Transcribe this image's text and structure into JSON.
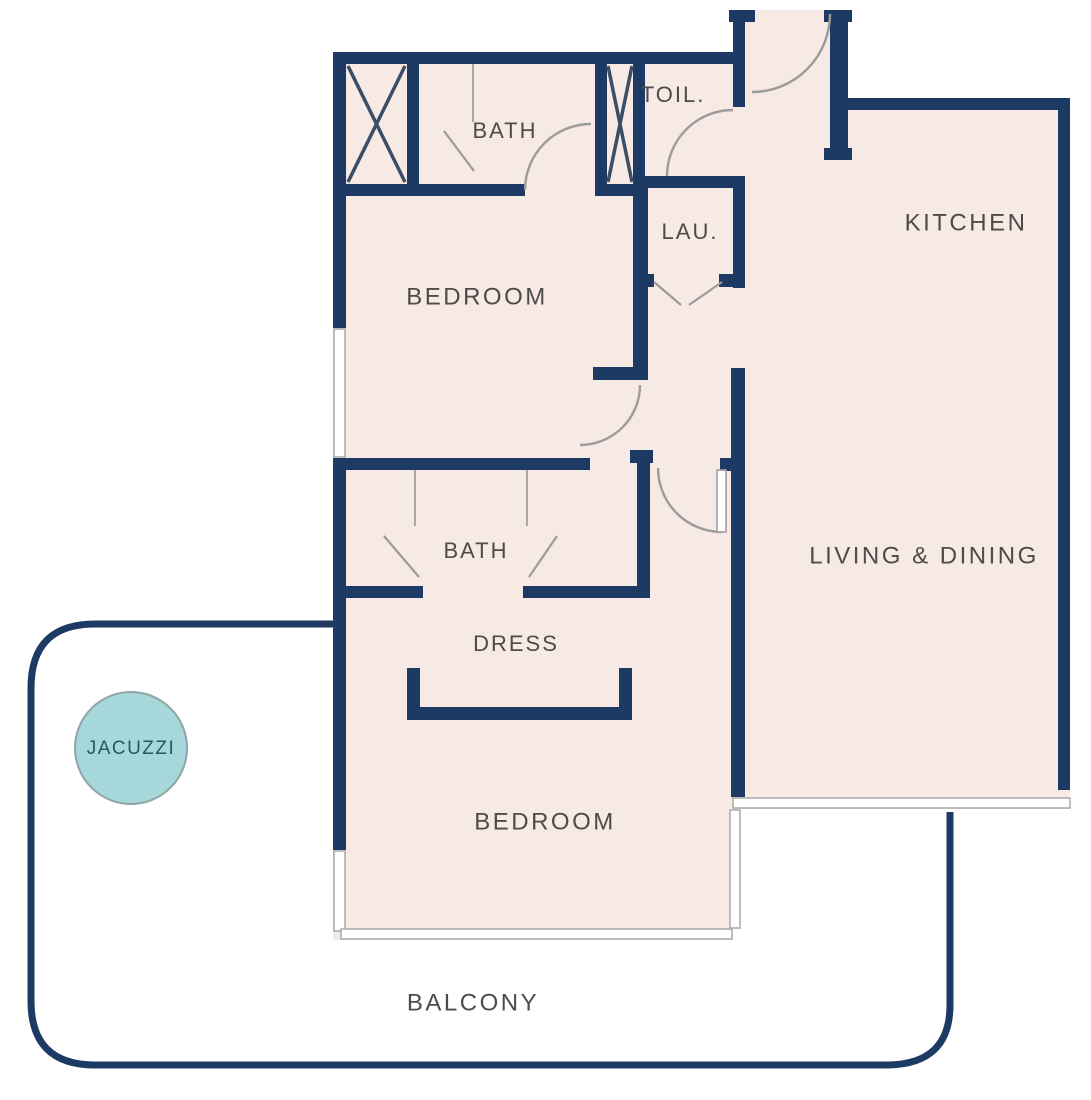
{
  "title": "Apartment floor plan",
  "rooms": {
    "bath_top": "BATH",
    "toilet": "TOIL.",
    "kitchen": "KITCHEN",
    "laundry": "LAU.",
    "bedroom_top": "BEDROOM",
    "living_dining": "LIVING & DINING",
    "bath_lower": "BATH",
    "dress": "DRESS",
    "bedroom_lower": "BEDROOM",
    "balcony": "BALCONY",
    "jacuzzi": "JACUZZI"
  },
  "colors": {
    "background": "#ffffff",
    "wall": "#1c3a63",
    "floor": "#f7e9e3",
    "label": "#4e4c49",
    "door_line": "#9b9b9b",
    "window_line": "#a8a8a8",
    "shaft_x": "#3a4e68",
    "jacuzzi_fill": "#a6d7da",
    "jacuzzi_stroke": "#8fa6a8",
    "jacuzzi_text": "#1f5b66"
  }
}
